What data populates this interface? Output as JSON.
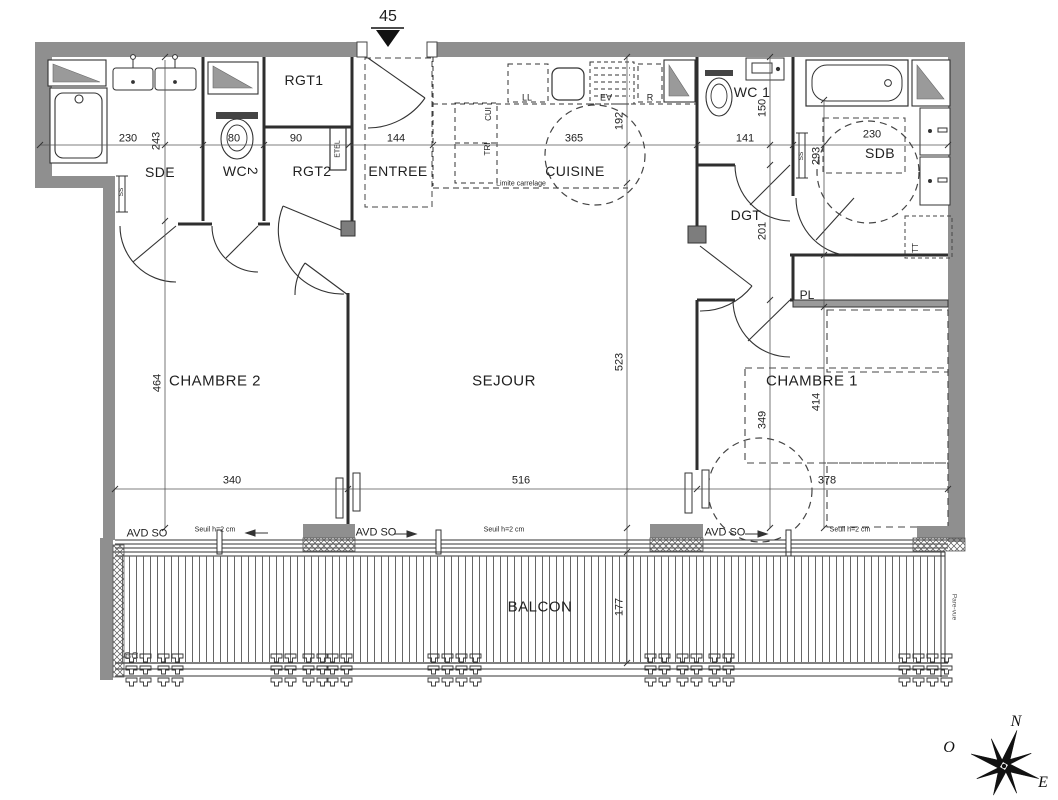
{
  "plan": {
    "entry_marker": "45",
    "rooms": {
      "rgt1": "RGT1",
      "sde": "SDE",
      "wc2": "WC",
      "wc2_num": "2",
      "rgt2": "RGT2",
      "entree": "ENTREE",
      "cuisine": "CUISINE",
      "wc1": "WC 1",
      "sdb": "SDB",
      "dgt": "DGT",
      "pl": "PL",
      "chambre2": "CHAMBRE 2",
      "sejour": "SEJOUR",
      "chambre1": "CHAMBRE 1",
      "balcon": "BALCON"
    },
    "equipment": {
      "etel": "ETEL",
      "cui": "CUI",
      "tri": "TRI",
      "ll": "LL",
      "ev": "EV",
      "r": "R",
      "ss_sde": "SS",
      "ss_sdb": "SS",
      "tt": "TT"
    },
    "notes": {
      "limite_carrelage": "Limite carrelage",
      "gc": "GC",
      "pare_vue": "Pare-vue",
      "avd_so_1": "AVD SO",
      "avd_so_2": "AVD SO",
      "avd_so_3": "AVD SO",
      "seuil_1": "Seuil h=2 cm",
      "seuil_2": "Seuil h=2 cm",
      "seuil_3": "Seuil h=2 cm"
    },
    "dimensions_cm": {
      "sde_w": "230",
      "sde_d": "243",
      "wc2_w": "80",
      "rgt2_w": "90",
      "entree_w": "144",
      "cuisine_w": "365",
      "cuisine_d": "192",
      "wc1_w": "141",
      "wc1_d": "150",
      "sdb_w": "230",
      "sdb_d": "293",
      "dgt_d": "201",
      "chambre2_d": "464",
      "chambre2_w": "340",
      "sejour_w": "516",
      "sejour_d": "523",
      "chambre1_d1": "349",
      "chambre1_d2": "414",
      "chambre1_w": "378",
      "balcon_d": "177"
    },
    "compass": {
      "north": "N",
      "west": "O",
      "east": "E"
    }
  }
}
